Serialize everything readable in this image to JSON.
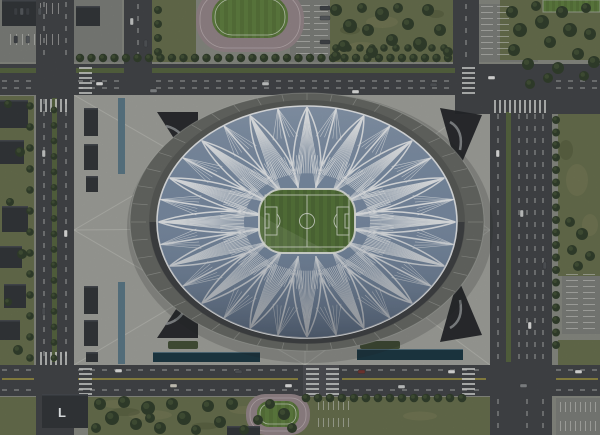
{
  "rooftop_label": "L",
  "palette": {
    "ground": "#8d9087",
    "lot": "#82847f",
    "grass": "#6c7451",
    "mottleLight": "#7d815c",
    "mottleDark": "#545c3d",
    "tree": "#35422f",
    "treeLight": "#4b5a3c",
    "road": "#46484b",
    "roadLight": "#55585b",
    "median": "#5b6a44",
    "laneWhite": "#dadcd9",
    "laneYellow": "#cfbe45",
    "plaza": "#a7a8a2",
    "plazaLine": "#d2d3cd",
    "concourse": "#6b6d68",
    "bowl": "#5d5f5c",
    "bowlShadow": "#2c3036",
    "roofBlue": "#8093ab",
    "roofWhite": "#f3f6f8",
    "pitch": "#54713a",
    "pitchStripe": "#5d7c40",
    "pitchLine": "#e2e8dc",
    "track": "#9a8b8e",
    "trackLine": "#c8bcbe",
    "field": "#5d7a3e",
    "fieldStripe": "#668745",
    "building": "#36393d",
    "buildingEdge": "#575b60",
    "entrance": "#26292d",
    "entranceMark": "#9fa2a5",
    "water": "#5f7d8c",
    "pool": "#1e3b47",
    "hedge": "#47543a"
  },
  "grass": [
    [
      330,
      0,
      123,
      62
    ],
    [
      152,
      0,
      44,
      62
    ],
    [
      500,
      0,
      100,
      60
    ],
    [
      558,
      114,
      42,
      162
    ],
    [
      88,
      397,
      424,
      38
    ],
    [
      0,
      397,
      40,
      38
    ],
    [
      0,
      96,
      34,
      300
    ],
    [
      76,
      96,
      42,
      80
    ],
    [
      76,
      282,
      42,
      82
    ],
    [
      479,
      98,
      10,
      56
    ],
    [
      479,
      306,
      10,
      56
    ],
    [
      558,
      340,
      42,
      26
    ]
  ],
  "mottle_light": [
    [
      150,
      415,
      44,
      10
    ],
    [
      244,
      410,
      30,
      8
    ],
    [
      420,
      416,
      34,
      9
    ],
    [
      382,
      22,
      32,
      12
    ],
    [
      362,
      46,
      26,
      8
    ],
    [
      577,
      180,
      22,
      32
    ],
    [
      590,
      225,
      16,
      22
    ],
    [
      115,
      404,
      26,
      8
    ]
  ],
  "mottle_dark": [
    [
      125,
      412,
      30,
      8
    ],
    [
      205,
      426,
      26,
      7
    ],
    [
      350,
      30,
      20,
      9
    ],
    [
      436,
      14,
      16,
      8
    ],
    [
      566,
      150,
      14,
      20
    ]
  ],
  "lots": [
    [
      0,
      0,
      122,
      62
    ],
    [
      290,
      0,
      40,
      62
    ],
    [
      478,
      4,
      60,
      58
    ],
    [
      562,
      270,
      38,
      64
    ],
    [
      556,
      398,
      44,
      37
    ],
    [
      312,
      397,
      58,
      38
    ]
  ],
  "plaza": [
    74,
    95,
    416,
    270
  ],
  "plaza_lines": [
    [
      305,
      228,
      74,
      95
    ],
    [
      305,
      228,
      490,
      95
    ],
    [
      305,
      228,
      74,
      365
    ],
    [
      305,
      228,
      490,
      365
    ],
    [
      305,
      228,
      74,
      230
    ],
    [
      305,
      228,
      490,
      230
    ],
    [
      305,
      228,
      305,
      95
    ],
    [
      305,
      228,
      305,
      365
    ],
    [
      74,
      230,
      305,
      95
    ],
    [
      305,
      95,
      490,
      230
    ],
    [
      490,
      230,
      305,
      365
    ],
    [
      305,
      365,
      74,
      230
    ]
  ],
  "left_channel": [
    [
      118,
      98,
      7,
      76
    ],
    [
      118,
      282,
      7,
      82
    ]
  ],
  "pools": [
    [
      153,
      352,
      107,
      10
    ],
    [
      357,
      349,
      106,
      11
    ]
  ],
  "hedges": [
    [
      168,
      341,
      30,
      8
    ],
    [
      360,
      341,
      40,
      8
    ]
  ],
  "buildings": [
    [
      2,
      0,
      34,
      26
    ],
    [
      76,
      6,
      24,
      20
    ],
    [
      0,
      100,
      28,
      28
    ],
    [
      0,
      140,
      24,
      24
    ],
    [
      2,
      206,
      26,
      26
    ],
    [
      0,
      246,
      22,
      22
    ],
    [
      4,
      284,
      22,
      24
    ],
    [
      0,
      320,
      20,
      20
    ],
    [
      84,
      108,
      14,
      28
    ],
    [
      84,
      144,
      14,
      26
    ],
    [
      86,
      176,
      12,
      16
    ],
    [
      84,
      286,
      14,
      28
    ],
    [
      84,
      320,
      14,
      26
    ],
    [
      86,
      352,
      12,
      10
    ],
    [
      227,
      426,
      33,
      9
    ]
  ],
  "l_building": [
    42,
    394,
    46,
    34
  ],
  "l_text": {
    "x": 58,
    "y": 417
  },
  "entrances": [
    [
      [
        157,
        112
      ],
      [
        198,
        112
      ],
      [
        198,
        176
      ]
    ],
    [
      [
        440,
        108
      ],
      [
        482,
        115
      ],
      [
        458,
        172
      ]
    ],
    [
      [
        157,
        338
      ],
      [
        198,
        338
      ],
      [
        198,
        276
      ]
    ],
    [
      [
        440,
        342
      ],
      [
        482,
        335
      ],
      [
        458,
        278
      ]
    ]
  ],
  "entrance_marks": [
    "M166,126 Q184,130 188,150",
    "M450,122 Q464,130 460,150",
    "M166,324 Q184,320 188,300",
    "M450,328 Q464,320 460,300"
  ],
  "roads": {
    "rects": [
      [
        0,
        64,
        600,
        31
      ],
      [
        0,
        365,
        600,
        31
      ],
      [
        36,
        0,
        38,
        435
      ],
      [
        490,
        64,
        62,
        371
      ],
      [
        124,
        0,
        28,
        64
      ],
      [
        453,
        0,
        26,
        64
      ],
      [
        455,
        64,
        145,
        50
      ]
    ],
    "medians": [
      [
        152,
        68,
        303,
        5
      ],
      [
        0,
        68,
        36,
        5
      ],
      [
        76,
        68,
        48,
        5
      ],
      [
        52,
        98,
        5,
        264
      ],
      [
        506,
        112,
        5,
        250
      ]
    ],
    "cross_band": [
      303,
      365,
      36,
      31
    ],
    "dashes": [
      [
        2,
        81,
        34,
        81
      ],
      [
        78,
        81,
        122,
        81
      ],
      [
        156,
        81,
        450,
        81
      ],
      [
        556,
        81,
        598,
        81
      ],
      [
        2,
        88,
        34,
        88
      ],
      [
        78,
        88,
        122,
        88
      ],
      [
        156,
        88,
        450,
        88
      ],
      [
        556,
        88,
        598,
        88
      ],
      [
        2,
        370,
        34,
        370
      ],
      [
        78,
        370,
        298,
        370
      ],
      [
        342,
        370,
        486,
        370
      ],
      [
        556,
        370,
        598,
        370
      ],
      [
        2,
        390,
        34,
        390
      ],
      [
        78,
        390,
        298,
        390
      ],
      [
        342,
        390,
        486,
        390
      ],
      [
        556,
        390,
        598,
        390
      ],
      [
        44,
        2,
        44,
        60
      ],
      [
        66,
        2,
        66,
        60
      ],
      [
        44,
        99,
        44,
        361
      ],
      [
        66,
        99,
        66,
        361
      ],
      [
        44,
        399,
        44,
        433
      ],
      [
        66,
        399,
        66,
        433
      ],
      [
        498,
        114,
        498,
        360
      ],
      [
        519,
        114,
        519,
        360
      ],
      [
        527,
        114,
        527,
        360
      ],
      [
        535,
        114,
        535,
        360
      ],
      [
        543,
        114,
        543,
        360
      ],
      [
        498,
        399,
        498,
        433
      ],
      [
        527,
        399,
        527,
        433
      ],
      [
        543,
        399,
        543,
        433
      ],
      [
        138,
        4,
        138,
        58
      ],
      [
        466,
        4,
        466,
        58
      ]
    ],
    "yellow": [
      [
        2,
        379,
        34,
        379
      ],
      [
        78,
        379,
        298,
        379
      ],
      [
        342,
        379,
        486,
        379
      ],
      [
        556,
        379,
        598,
        379
      ]
    ]
  },
  "crosswalks": [
    {
      "x": 79,
      "y": 67,
      "n": 6,
      "h": true
    },
    {
      "x": 462,
      "y": 67,
      "n": 6,
      "h": true
    },
    {
      "x": 79,
      "y": 368,
      "n": 6,
      "h": true
    },
    {
      "x": 462,
      "y": 368,
      "n": 6,
      "h": true
    },
    {
      "x": 306,
      "y": 368,
      "n": 6,
      "h": true
    },
    {
      "x": 326,
      "y": 368,
      "n": 6,
      "h": true
    },
    {
      "x": 40,
      "y": 99,
      "n": 6,
      "h": false
    },
    {
      "x": 40,
      "y": 352,
      "n": 6,
      "h": false
    },
    {
      "x": 494,
      "y": 100,
      "n": 11,
      "h": false
    }
  ],
  "parking": [
    {
      "x": 10,
      "y": 3,
      "n": 9,
      "gap": 6,
      "len": 11,
      "v": true
    },
    {
      "x": 10,
      "y": 34,
      "n": 9,
      "gap": 6,
      "len": 11,
      "v": true
    },
    {
      "x": 296,
      "y": 5,
      "n": 9,
      "gap": 6,
      "len": 14,
      "v": false
    },
    {
      "x": 314,
      "y": 5,
      "n": 9,
      "gap": 6,
      "len": 14,
      "v": false
    },
    {
      "x": 481,
      "y": 6,
      "n": 9,
      "gap": 6,
      "len": 12,
      "v": false
    },
    {
      "x": 497,
      "y": 6,
      "n": 9,
      "gap": 6,
      "len": 12,
      "v": false
    },
    {
      "x": 566,
      "y": 274,
      "n": 10,
      "gap": 6,
      "len": 12,
      "v": false
    },
    {
      "x": 583,
      "y": 274,
      "n": 10,
      "gap": 6,
      "len": 12,
      "v": false
    },
    {
      "x": 560,
      "y": 402,
      "n": 8,
      "gap": 5,
      "len": 10,
      "v": true
    },
    {
      "x": 560,
      "y": 421,
      "n": 8,
      "gap": 5,
      "len": 10,
      "v": true
    },
    {
      "x": 318,
      "y": 401,
      "n": 7,
      "gap": 5,
      "len": 9,
      "v": true
    },
    {
      "x": 318,
      "y": 418,
      "n": 7,
      "gap": 5,
      "len": 9,
      "v": true
    }
  ],
  "tracks": [
    {
      "ox": 196,
      "oy": -12,
      "ow": 108,
      "oh": 64,
      "orr": 30,
      "ix": 212,
      "iy": -4,
      "iw": 76,
      "ih": 42,
      "ir": 20
    },
    {
      "ox": 246,
      "oy": 394,
      "ow": 64,
      "oh": 41,
      "orr": 19,
      "ix": 257,
      "iy": 401,
      "iw": 42,
      "ih": 26,
      "ir": 12
    }
  ],
  "corner_field": [
    543,
    0,
    57,
    12
  ],
  "tree_rows": [
    [
      80,
      58,
      11.5,
      0,
      33,
      4.2
    ],
    [
      336,
      48,
      12,
      0,
      10,
      3.8
    ],
    [
      54,
      110,
      0,
      15.5,
      17,
      3.4
    ],
    [
      30,
      106,
      0,
      21,
      13,
      3.8
    ],
    [
      556,
      120,
      0,
      12.5,
      19,
      4
    ],
    [
      306,
      398,
      12,
      0,
      14,
      4.3
    ],
    [
      158,
      10,
      0,
      14,
      4,
      4
    ]
  ],
  "tree_clusters": [
    [
      336,
      10,
      6
    ],
    [
      350,
      26,
      7
    ],
    [
      344,
      46,
      6
    ],
    [
      362,
      8,
      5
    ],
    [
      368,
      30,
      6
    ],
    [
      382,
      14,
      7
    ],
    [
      392,
      40,
      6
    ],
    [
      398,
      8,
      5
    ],
    [
      408,
      24,
      6
    ],
    [
      420,
      44,
      7
    ],
    [
      428,
      10,
      6
    ],
    [
      440,
      30,
      6
    ],
    [
      448,
      52,
      5
    ],
    [
      336,
      56,
      5
    ],
    [
      372,
      52,
      6
    ],
    [
      512,
      12,
      6
    ],
    [
      520,
      30,
      7
    ],
    [
      514,
      50,
      6
    ],
    [
      528,
      64,
      6
    ],
    [
      536,
      6,
      5
    ],
    [
      542,
      22,
      7
    ],
    [
      550,
      42,
      6
    ],
    [
      558,
      68,
      6
    ],
    [
      562,
      12,
      6
    ],
    [
      570,
      30,
      7
    ],
    [
      578,
      54,
      6
    ],
    [
      586,
      8,
      5
    ],
    [
      590,
      34,
      6
    ],
    [
      594,
      62,
      6
    ],
    [
      548,
      78,
      5
    ],
    [
      584,
      76,
      5
    ],
    [
      530,
      84,
      5
    ],
    [
      570,
      222,
      5
    ],
    [
      582,
      234,
      6
    ],
    [
      572,
      250,
      5
    ],
    [
      590,
      256,
      5
    ],
    [
      578,
      266,
      5
    ],
    [
      100,
      404,
      6
    ],
    [
      112,
      418,
      7
    ],
    [
      124,
      402,
      6
    ],
    [
      136,
      424,
      6
    ],
    [
      148,
      408,
      7
    ],
    [
      160,
      428,
      6
    ],
    [
      172,
      404,
      6
    ],
    [
      184,
      418,
      7
    ],
    [
      196,
      430,
      5
    ],
    [
      208,
      406,
      6
    ],
    [
      220,
      422,
      6
    ],
    [
      232,
      404,
      6
    ],
    [
      244,
      430,
      5
    ],
    [
      150,
      418,
      5
    ],
    [
      258,
      420,
      5
    ],
    [
      270,
      404,
      5
    ],
    [
      96,
      428,
      5
    ],
    [
      284,
      414,
      6
    ],
    [
      292,
      428,
      5
    ],
    [
      8,
      104,
      4
    ],
    [
      20,
      152,
      5
    ],
    [
      10,
      202,
      4
    ],
    [
      22,
      254,
      5
    ],
    [
      8,
      302,
      4
    ],
    [
      18,
      350,
      5
    ]
  ],
  "cars": [
    [
      96,
      82,
      7,
      3.5,
      "#e9eae8"
    ],
    [
      150,
      89,
      7,
      3.5,
      "#8a8d90"
    ],
    [
      262,
      82,
      7,
      3.5,
      "#cfd1d0"
    ],
    [
      352,
      90,
      7,
      3.5,
      "#e9eae8"
    ],
    [
      430,
      83,
      7,
      3.5,
      "#55585c"
    ],
    [
      488,
      76,
      7,
      3.5,
      "#e9eae8"
    ],
    [
      115,
      369,
      7,
      3.5,
      "#e9eae8"
    ],
    [
      170,
      384,
      7,
      3.5,
      "#d8d5c8"
    ],
    [
      235,
      370,
      7,
      3.5,
      "#55585c"
    ],
    [
      285,
      384,
      7,
      3.5,
      "#e9eae8"
    ],
    [
      358,
      370,
      7,
      3.5,
      "#7a3a34"
    ],
    [
      398,
      385,
      7,
      3.5,
      "#cfd1d0"
    ],
    [
      448,
      370,
      7,
      3.5,
      "#e9eae8"
    ],
    [
      520,
      384,
      7,
      3.5,
      "#8a8d90"
    ],
    [
      575,
      370,
      7,
      3.5,
      "#e9eae8"
    ],
    [
      42,
      150,
      3.5,
      7,
      "#cfd1d0"
    ],
    [
      64,
      230,
      3.5,
      7,
      "#e9eae8"
    ],
    [
      42,
      308,
      3.5,
      7,
      "#55585c"
    ],
    [
      496,
      150,
      3.5,
      7,
      "#e9eae8"
    ],
    [
      520,
      210,
      3.5,
      7,
      "#cfd1d0"
    ],
    [
      543,
      262,
      3.5,
      7,
      "#55585c"
    ],
    [
      528,
      322,
      3.5,
      7,
      "#e9eae8"
    ],
    [
      130,
      18,
      3.5,
      7,
      "#cfd1d0"
    ],
    [
      144,
      40,
      3.5,
      7,
      "#55585c"
    ],
    [
      14,
      8,
      3.5,
      7,
      "#43474c"
    ],
    [
      20,
      8,
      3.5,
      7,
      "#5a5e63"
    ],
    [
      26,
      8,
      3.5,
      7,
      "#43474c"
    ],
    [
      38,
      8,
      3.5,
      7,
      "#5a5e63"
    ],
    [
      14,
      36,
      3.5,
      7,
      "#43474c"
    ],
    [
      26,
      36,
      3.5,
      7,
      "#5a5e63"
    ],
    [
      320,
      6,
      10,
      4,
      "#43474c"
    ],
    [
      320,
      16,
      10,
      4,
      "#5a5e63"
    ],
    [
      320,
      40,
      10,
      4,
      "#43474c"
    ]
  ],
  "stadium": {
    "cx": 307,
    "cy": 222,
    "rx": 150,
    "ry": 116,
    "petals": 16,
    "concourse_rx": 177,
    "concourse_ry": 129,
    "bowl_rx": 158,
    "bowl_ry": 122
  },
  "pitch": {
    "x": 259,
    "y": 189,
    "w": 96,
    "h": 64,
    "r": 24
  }
}
